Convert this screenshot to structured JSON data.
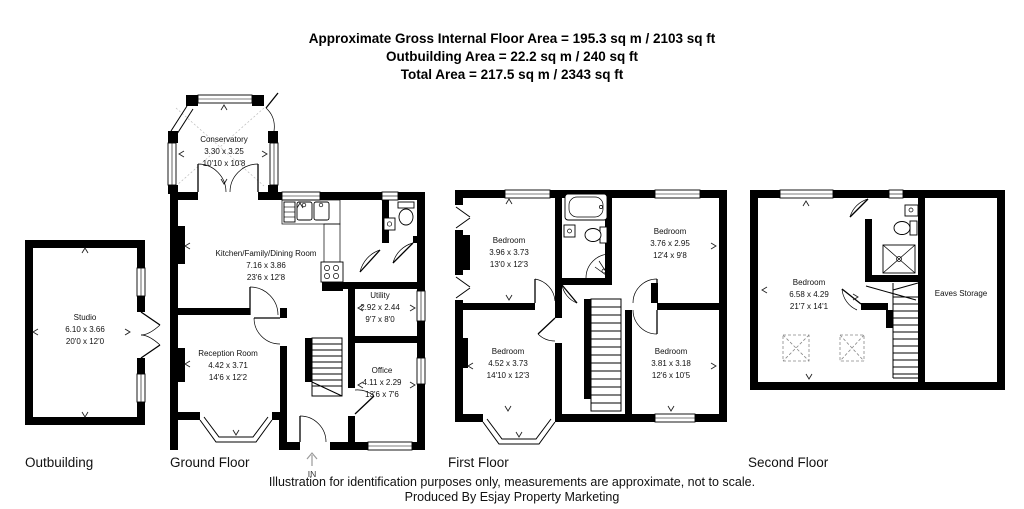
{
  "header": {
    "line1": "Approximate Gross Internal Floor Area = 195.3 sq m / 2103 sq ft",
    "line2": "Outbuilding Area = 22.2 sq m / 240 sq ft",
    "line3": "Total Area = 217.5 sq m / 2343 sq ft"
  },
  "floors": {
    "outbuilding": {
      "label": "Outbuilding",
      "rooms": {
        "studio": {
          "name": "Studio",
          "metric": "6.10 x 3.66",
          "imperial": "20'0 x 12'0"
        }
      }
    },
    "ground": {
      "label": "Ground Floor",
      "entrance": "IN",
      "rooms": {
        "conservatory": {
          "name": "Conservatory",
          "metric": "3.30 x 3.25",
          "imperial": "10'10 x 10'8"
        },
        "kitchen": {
          "name": "Kitchen/Family/Dining Room",
          "metric": "7.16 x 3.86",
          "imperial": "23'6 x 12'8"
        },
        "utility": {
          "name": "Utility",
          "metric": "2.92 x 2.44",
          "imperial": "9'7 x 8'0"
        },
        "reception": {
          "name": "Reception Room",
          "metric": "4.42 x 3.71",
          "imperial": "14'6 x 12'2"
        },
        "office": {
          "name": "Office",
          "metric": "4.11 x 2.29",
          "imperial": "13'6 x 7'6"
        }
      }
    },
    "first": {
      "label": "First Floor",
      "rooms": {
        "bedroom1": {
          "name": "Bedroom",
          "metric": "3.96 x 3.73",
          "imperial": "13'0 x 12'3"
        },
        "bedroom2": {
          "name": "Bedroom",
          "metric": "3.76 x 2.95",
          "imperial": "12'4 x 9'8"
        },
        "bedroom3": {
          "name": "Bedroom",
          "metric": "4.52 x 3.73",
          "imperial": "14'10 x 12'3"
        },
        "bedroom4": {
          "name": "Bedroom",
          "metric": "3.81 x 3.18",
          "imperial": "12'6 x 10'5"
        }
      }
    },
    "second": {
      "label": "Second Floor",
      "rooms": {
        "bedroom": {
          "name": "Bedroom",
          "metric": "6.58 x 4.29",
          "imperial": "21'7 x 14'1"
        },
        "eaves": {
          "name": "Eaves Storage"
        }
      }
    }
  },
  "footer": {
    "line1": "Illustration for identification purposes only, measurements are approximate, not to scale.",
    "line2": "Produced By Esjay Property Marketing"
  }
}
